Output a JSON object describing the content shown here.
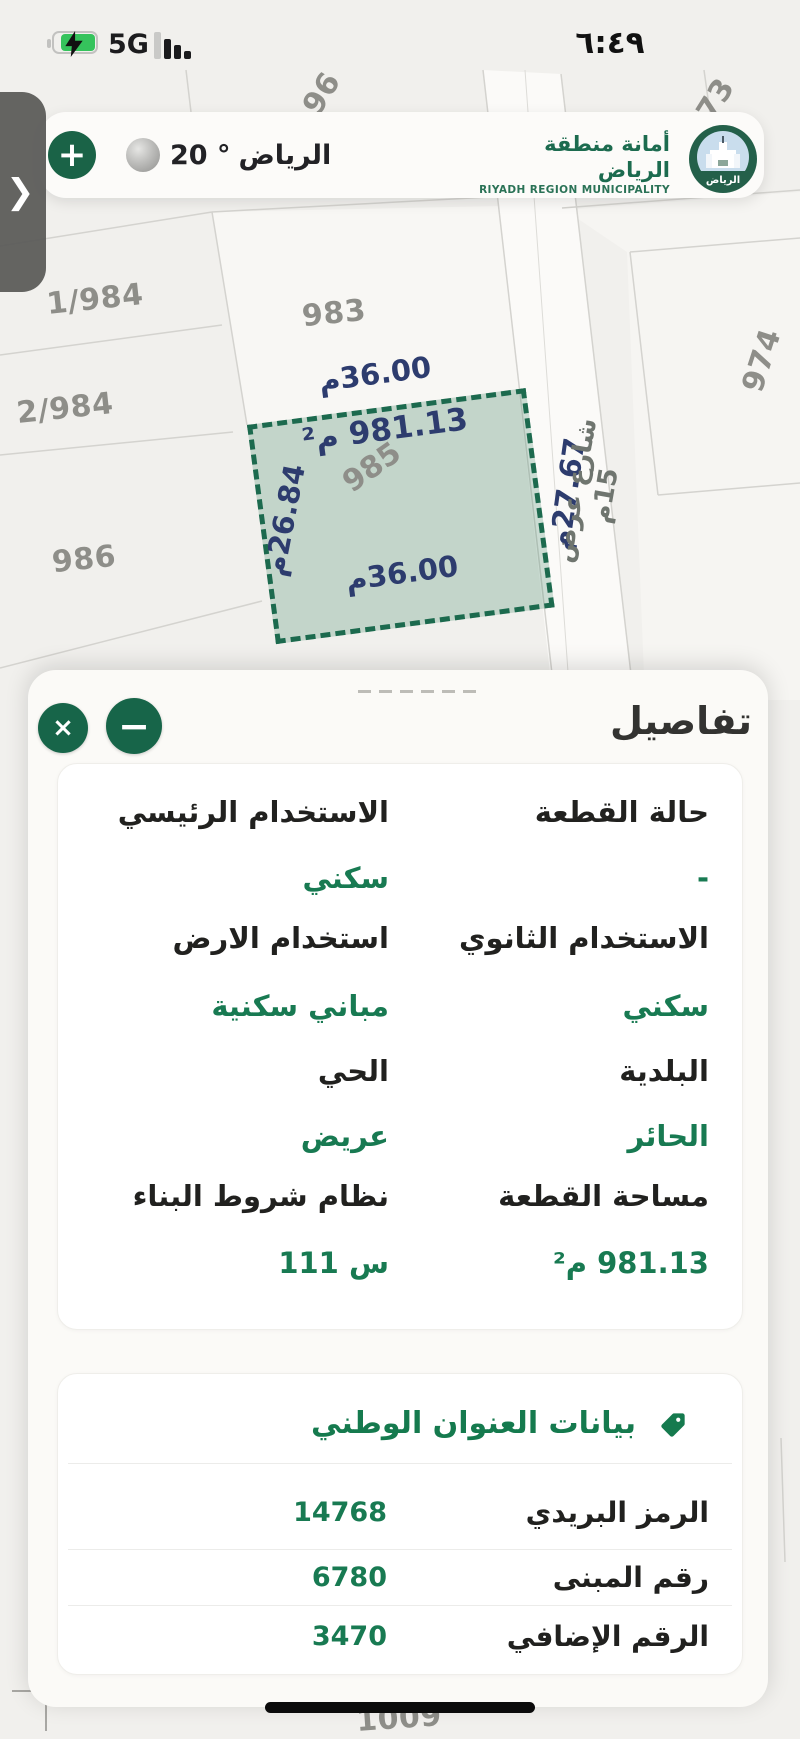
{
  "status_bar": {
    "time": "٦:٤٩",
    "network": "5G"
  },
  "icons": {
    "plus": "+",
    "close": "×",
    "minimize": "−",
    "chevron": "❯"
  },
  "header": {
    "weather": {
      "temp": "20 °",
      "city": "الرياض"
    },
    "logo": {
      "title_ar": "أمانة منطقة الرياض",
      "title_en": "RIYADH REGION MUNICIPALITY",
      "emblem_city": "الرياض"
    }
  },
  "map": {
    "parcel_labels": {
      "p1984": "1/984",
      "p983": "983",
      "p2984": "2/984",
      "p986": "986",
      "p974": "974",
      "p96": "96",
      "p73": "73",
      "p1009": "1009"
    },
    "selected_parcel": {
      "number": "985",
      "area": "981.13 م²",
      "dim_top": "36.00م",
      "dim_bottom": "36.00م",
      "dim_left": "26.84م",
      "dim_right": "27.67م"
    },
    "street_label": "شارع عرض 15م",
    "colors": {
      "parcel_fill": "rgba(67,135,103,0.26)",
      "parcel_border": "#1c6a4e",
      "dimension_text": "#2d3c6e",
      "label_gray": "#8e8e89"
    }
  },
  "sheet": {
    "title": "تفاصيل",
    "details": {
      "rows": [
        {
          "right": {
            "label": "حالة القطعة",
            "value": "-"
          },
          "left": {
            "label": "الاستخدام الرئيسي",
            "value": "سكني"
          }
        },
        {
          "right": {
            "label": "الاستخدام الثانوي",
            "value": "سكني"
          },
          "left": {
            "label": "استخدام الارض",
            "value": "مباني سكنية"
          }
        },
        {
          "right": {
            "label": "البلدية",
            "value": "الحائر"
          },
          "left": {
            "label": "الحي",
            "value": "عريض"
          }
        },
        {
          "right": {
            "label": "مساحة القطعة",
            "value": "981.13 م²"
          },
          "left": {
            "label": "نظام شروط البناء",
            "value": "س 111"
          }
        }
      ]
    },
    "national_address": {
      "title": "بيانات العنوان الوطني",
      "rows": [
        {
          "label": "الرمز البريدي",
          "value": "14768"
        },
        {
          "label": "رقم المبنى",
          "value": "6780"
        },
        {
          "label": "الرقم الإضافي",
          "value": "3470"
        }
      ]
    }
  }
}
